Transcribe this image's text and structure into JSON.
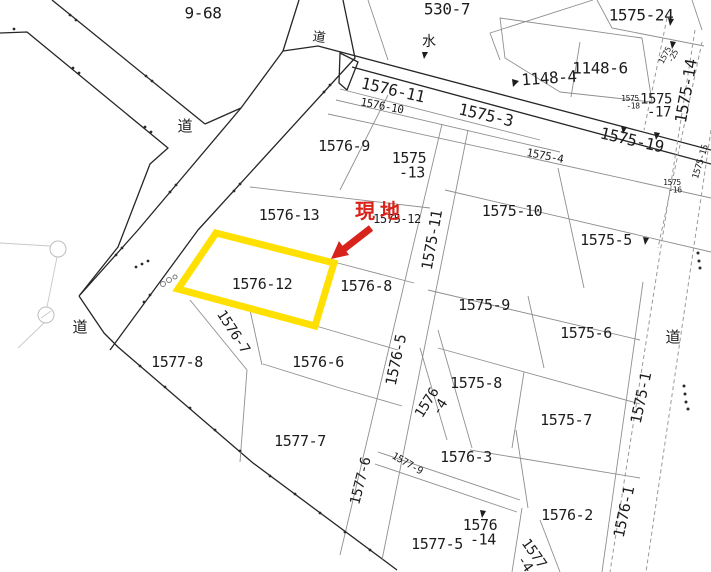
{
  "map": {
    "title_hint": "cadastral parcel map",
    "highlight": {
      "parcel": "1576-12",
      "outline_color": "#ffe000",
      "marker_text": "現地",
      "marker_color": "#d8231b"
    },
    "labels": [
      {
        "name": "parcel-label-9-68",
        "text": "9-68",
        "x": 203,
        "y": 13,
        "rot": 0,
        "size": 16
      },
      {
        "name": "road-label-top",
        "text": "道",
        "x": 319,
        "y": 38,
        "rot": 8,
        "size": 13,
        "cls": "kanji"
      },
      {
        "name": "parcel-label-530-7",
        "text": "530-7",
        "x": 447,
        "y": 9,
        "rot": 0,
        "size": 16
      },
      {
        "name": "water-mark-label",
        "text": "水",
        "x": 429,
        "y": 42,
        "rot": 0,
        "size": 14,
        "cls": "kanji"
      },
      {
        "name": "parcel-label-1575-24",
        "text": "1575-24",
        "x": 641,
        "y": 15,
        "rot": 0,
        "size": 16
      },
      {
        "name": "parcel-label-1148-4",
        "text": "1148-4",
        "x": 549,
        "y": 78,
        "rot": -4,
        "size": 16
      },
      {
        "name": "parcel-label-1148-6",
        "text": "1148-6",
        "x": 600,
        "y": 68,
        "rot": 0,
        "size": 16
      },
      {
        "name": "parcel-label-1575-25",
        "lines": [
          "1575",
          "-25"
        ],
        "x": 668,
        "y": 57,
        "rot": -62,
        "size": 8
      },
      {
        "name": "parcel-label-1575-14",
        "text": "1575-14",
        "x": 686,
        "y": 91,
        "rot": -80,
        "size": 16
      },
      {
        "name": "parcel-label-1576-11",
        "text": "1576-11",
        "x": 393,
        "y": 90,
        "rot": 13,
        "size": 16
      },
      {
        "name": "parcel-label-1576-10",
        "text": "1576-10",
        "x": 382,
        "y": 106,
        "rot": 11,
        "size": 11
      },
      {
        "name": "parcel-label-1575-3",
        "text": "1575-3",
        "x": 486,
        "y": 115,
        "rot": 13,
        "size": 16
      },
      {
        "name": "parcel-label-1575-17",
        "lines": [
          "1575",
          "-17"
        ],
        "x": 656,
        "y": 105,
        "rot": 0,
        "size": 14
      },
      {
        "name": "parcel-label-1575-18",
        "lines": [
          "1575",
          "-18"
        ],
        "x": 630,
        "y": 102,
        "rot": 0,
        "size": 8
      },
      {
        "name": "parcel-label-1575-19",
        "text": "1575-19",
        "x": 632,
        "y": 140,
        "rot": 13,
        "size": 16
      },
      {
        "name": "parcel-label-1575-4",
        "text": "1575-4",
        "x": 545,
        "y": 156,
        "rot": 11,
        "size": 11
      },
      {
        "name": "parcel-label-1575-15",
        "text": "1575-15",
        "x": 701,
        "y": 162,
        "rot": -73,
        "size": 9
      },
      {
        "name": "parcel-label-1575-16",
        "lines": [
          "1575",
          "-16"
        ],
        "x": 672,
        "y": 186,
        "rot": 0,
        "size": 8
      },
      {
        "name": "road-label-left",
        "text": "道",
        "x": 185,
        "y": 126,
        "rot": 0,
        "size": 15,
        "cls": "kanji"
      },
      {
        "name": "parcel-label-1576-9",
        "text": "1576-9",
        "x": 344,
        "y": 146,
        "rot": 0,
        "size": 15
      },
      {
        "name": "parcel-label-1575-13",
        "lines": [
          "1575",
          "-13"
        ],
        "x": 409,
        "y": 165,
        "rot": 0,
        "size": 15
      },
      {
        "name": "parcel-label-1576-13",
        "text": "1576-13",
        "x": 289,
        "y": 215,
        "rot": 0,
        "size": 15
      },
      {
        "name": "parcel-label-1575-12",
        "text": "1575-12",
        "x": 397,
        "y": 219,
        "rot": 0,
        "size": 12
      },
      {
        "name": "parcel-label-1575-11",
        "text": "1575-11",
        "x": 432,
        "y": 240,
        "rot": -80,
        "size": 15
      },
      {
        "name": "parcel-label-1575-10",
        "text": "1575-10",
        "x": 512,
        "y": 211,
        "rot": 0,
        "size": 15
      },
      {
        "name": "parcel-label-1575-5",
        "text": "1575-5",
        "x": 606,
        "y": 240,
        "rot": 0,
        "size": 15
      },
      {
        "name": "highlight-parcel-label",
        "text": "1576-12",
        "x": 262,
        "y": 284,
        "rot": 0,
        "size": 15
      },
      {
        "name": "parcel-label-1576-8",
        "text": "1576-8",
        "x": 366,
        "y": 286,
        "rot": 0,
        "size": 15
      },
      {
        "name": "parcel-label-1575-9",
        "text": "1575-9",
        "x": 484,
        "y": 305,
        "rot": 0,
        "size": 15
      },
      {
        "name": "parcel-label-1575-6",
        "text": "1575-6",
        "x": 586,
        "y": 333,
        "rot": 0,
        "size": 15
      },
      {
        "name": "road-label-west",
        "text": "道",
        "x": 80,
        "y": 327,
        "rot": 0,
        "size": 15,
        "cls": "kanji"
      },
      {
        "name": "road-label-east",
        "text": "道",
        "x": 673,
        "y": 337,
        "rot": 0,
        "size": 15,
        "cls": "kanji"
      },
      {
        "name": "parcel-label-1576-7",
        "text": "1576-7",
        "x": 233,
        "y": 332,
        "rot": 57,
        "size": 14
      },
      {
        "name": "parcel-label-1577-8",
        "text": "1577-8",
        "x": 177,
        "y": 362,
        "rot": 0,
        "size": 15
      },
      {
        "name": "parcel-label-1576-6",
        "text": "1576-6",
        "x": 318,
        "y": 362,
        "rot": 0,
        "size": 15
      },
      {
        "name": "parcel-label-1576-5",
        "text": "1576-5",
        "x": 396,
        "y": 360,
        "rot": -78,
        "size": 15
      },
      {
        "name": "parcel-label-1575-8",
        "text": "1575-8",
        "x": 476,
        "y": 383,
        "rot": 0,
        "size": 15
      },
      {
        "name": "parcel-label-1576-4",
        "lines": [
          "1576",
          "-4"
        ],
        "x": 432,
        "y": 406,
        "rot": -58,
        "size": 14
      },
      {
        "name": "parcel-label-1575-7",
        "text": "1575-7",
        "x": 566,
        "y": 420,
        "rot": 0,
        "size": 15
      },
      {
        "name": "parcel-label-1575-1",
        "text": "1575-1",
        "x": 641,
        "y": 398,
        "rot": -78,
        "size": 15
      },
      {
        "name": "parcel-label-1577-7",
        "text": "1577-7",
        "x": 300,
        "y": 441,
        "rot": 0,
        "size": 15
      },
      {
        "name": "parcel-label-1577-6",
        "text": "1577-6",
        "x": 361,
        "y": 481,
        "rot": -76,
        "size": 14
      },
      {
        "name": "parcel-label-1577-9",
        "text": "1577-9",
        "x": 407,
        "y": 464,
        "rot": 30,
        "size": 10
      },
      {
        "name": "parcel-label-1576-3",
        "text": "1576-3",
        "x": 466,
        "y": 457,
        "rot": 0,
        "size": 15
      },
      {
        "name": "parcel-label-1576-2",
        "text": "1576-2",
        "x": 567,
        "y": 515,
        "rot": 0,
        "size": 15
      },
      {
        "name": "parcel-label-1576-1",
        "text": "1576-1",
        "x": 624,
        "y": 512,
        "rot": -78,
        "size": 15
      },
      {
        "name": "parcel-label-1577-5",
        "text": "1577-5",
        "x": 437,
        "y": 544,
        "rot": 0,
        "size": 15
      },
      {
        "name": "parcel-label-1576-14",
        "lines": [
          "1576",
          "-14"
        ],
        "x": 480,
        "y": 532,
        "rot": 0,
        "size": 15
      },
      {
        "name": "parcel-label-1577-4",
        "lines": [
          "1577",
          "-4"
        ],
        "x": 529,
        "y": 557,
        "rot": 55,
        "size": 14
      },
      {
        "name": "site-marker-text",
        "text": "現地",
        "x": 380,
        "y": 211,
        "rot": 0,
        "size": 20,
        "cls": "marker"
      }
    ]
  }
}
